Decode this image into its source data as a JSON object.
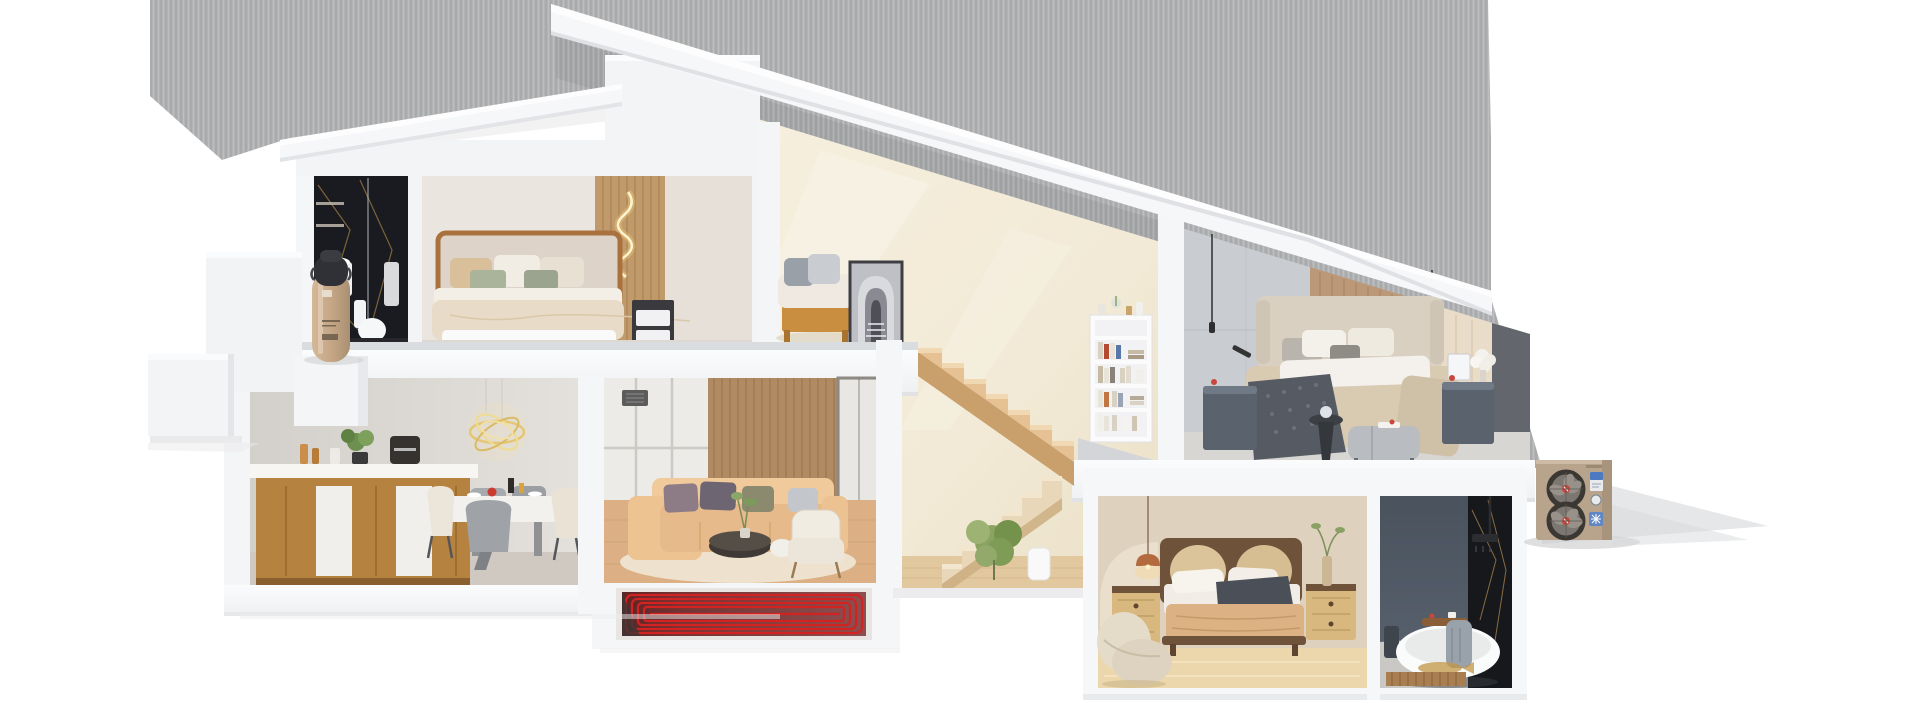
{
  "scene": {
    "title": "3D cutaway cross-section render of a two-story house with heat-pump heating system",
    "background_color": "#ffffff",
    "backdrop": {
      "color": "#b3b4b6",
      "texture": "vertical-stripes",
      "shadow_color": "#9c9ea2"
    },
    "palette": {
      "heating_red": "#d32222",
      "heating_red_dark": "#7a1515",
      "equipment_tan": "#b8a38c",
      "tank_tan": "#c3a584",
      "roof_white": "#f6f7f9",
      "cream_wall": "#f2ead6",
      "stair_wood": "#d9b184",
      "kitchen_wood": "#b5823f",
      "sofa_tan": "#e6ba8a",
      "marble_black": "#17181c",
      "marble_vein_gold": "#9c7c42",
      "slate_blue": "#505a66",
      "floor_wood": "#dcb084",
      "copper_lamp": "#b26a3e",
      "chandelier_gold": "#e2c065"
    }
  },
  "floors": [
    {
      "name": "upper floor",
      "rooms": [
        {
          "name": "en-suite bathroom",
          "style": "black marble with gold veining",
          "fixtures": [
            "glass shower",
            "wall niche shelves",
            "white sink cabinet",
            "toilet",
            "hanging towel"
          ]
        },
        {
          "name": "master bedroom",
          "furniture": [
            "wood-framed double bed",
            "beige and sage pillows",
            "wave LED wall light",
            "wood slat accent wall",
            "dark nightstand"
          ]
        },
        {
          "name": "reading nook",
          "furniture": [
            "daybed with tan base",
            "gray cushions",
            "framed arch artwork leaning on wall"
          ]
        },
        {
          "name": "second bedroom",
          "furniture": [
            "upholstered bed",
            "dark gray knit throw",
            "two slate nightstands",
            "white flower bouquet",
            "picture frame",
            "thin black pendant lights",
            "fabric bench",
            "round black side table",
            "white bookshelf with books and decor"
          ]
        }
      ]
    },
    {
      "name": "ground floor",
      "rooms": [
        {
          "name": "kitchen dining room",
          "furniture": [
            "gold scribble chandelier",
            "wood sideboard with white inset panels",
            "espresso machine",
            "potted plant",
            "amber bottles",
            "white dining table",
            "cream shell chairs",
            "gray chair",
            "red and yellow tableware"
          ]
        },
        {
          "name": "living room",
          "furniture": [
            "floor-to-ceiling window",
            "sheer curtains",
            "wood slat wall",
            "air vent",
            "tan corner sofa",
            "mauve and gray cushions",
            "round dark coffee table",
            "white drum table",
            "cream armchair",
            "oval rug",
            "potted plant",
            "glass sliding door"
          ]
        },
        {
          "name": "stair hall",
          "furniture": [
            "switchback open-riser wooden staircase",
            "leafy plant",
            "white vase"
          ]
        },
        {
          "name": "guest bedroom",
          "furniture": [
            "wood bed with double cane oval headboard",
            "white pillows",
            "dark gray throw",
            "tan blanket",
            "two cane-front nightstands",
            "copper pendant lamp",
            "vase with green branch",
            "curvy cream armchair",
            "arched wall niche"
          ]
        },
        {
          "name": "lower bathroom",
          "style": "dark slate and black marble",
          "fixtures": [
            "freestanding white bathtub",
            "wooden bath tray",
            "draped gray towel",
            "rain shower",
            "dark stool",
            "gold fish floor mat",
            "wood slat mat"
          ]
        }
      ]
    }
  ],
  "equipment": [
    {
      "name": "heat pump water tank",
      "color": "#c3a584",
      "cap_color": "#2f3136",
      "location": "upper floor left terrace"
    },
    {
      "name": "outdoor heat pump unit",
      "color": "#b8a38c",
      "fans": 2,
      "fan_hub_color": "#c9463a",
      "labels": [
        "blue energy sticker",
        "round badge",
        "blue snowflake sticker"
      ],
      "location": "ground level right of house"
    },
    {
      "name": "underfloor heating coil",
      "pipe_color": "#d32222",
      "panel_color": "#7a1515",
      "location": "below living room floor slab"
    }
  ]
}
